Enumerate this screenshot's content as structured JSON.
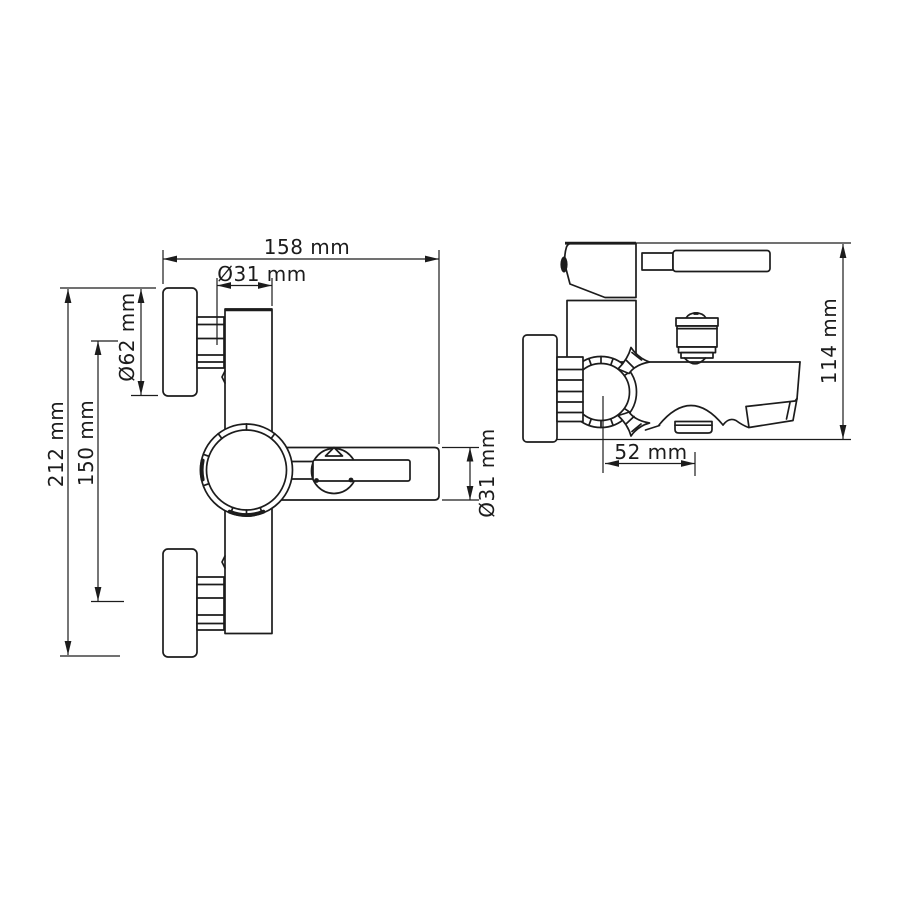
{
  "drawing": {
    "background_color": "#ffffff",
    "line_color": "#1c1c1c",
    "front_view": {
      "dim_overall_width": "158 mm",
      "dim_body_diameter": "Ø31 mm",
      "dim_flange_diameter": "Ø62 mm",
      "dim_connection_centers": "150 mm",
      "dim_overall_height": "212 mm",
      "dim_handle_diameter": "Ø31 mm"
    },
    "side_view": {
      "dim_overall_depth": "114 mm",
      "dim_spout_offset": "52 mm"
    }
  }
}
